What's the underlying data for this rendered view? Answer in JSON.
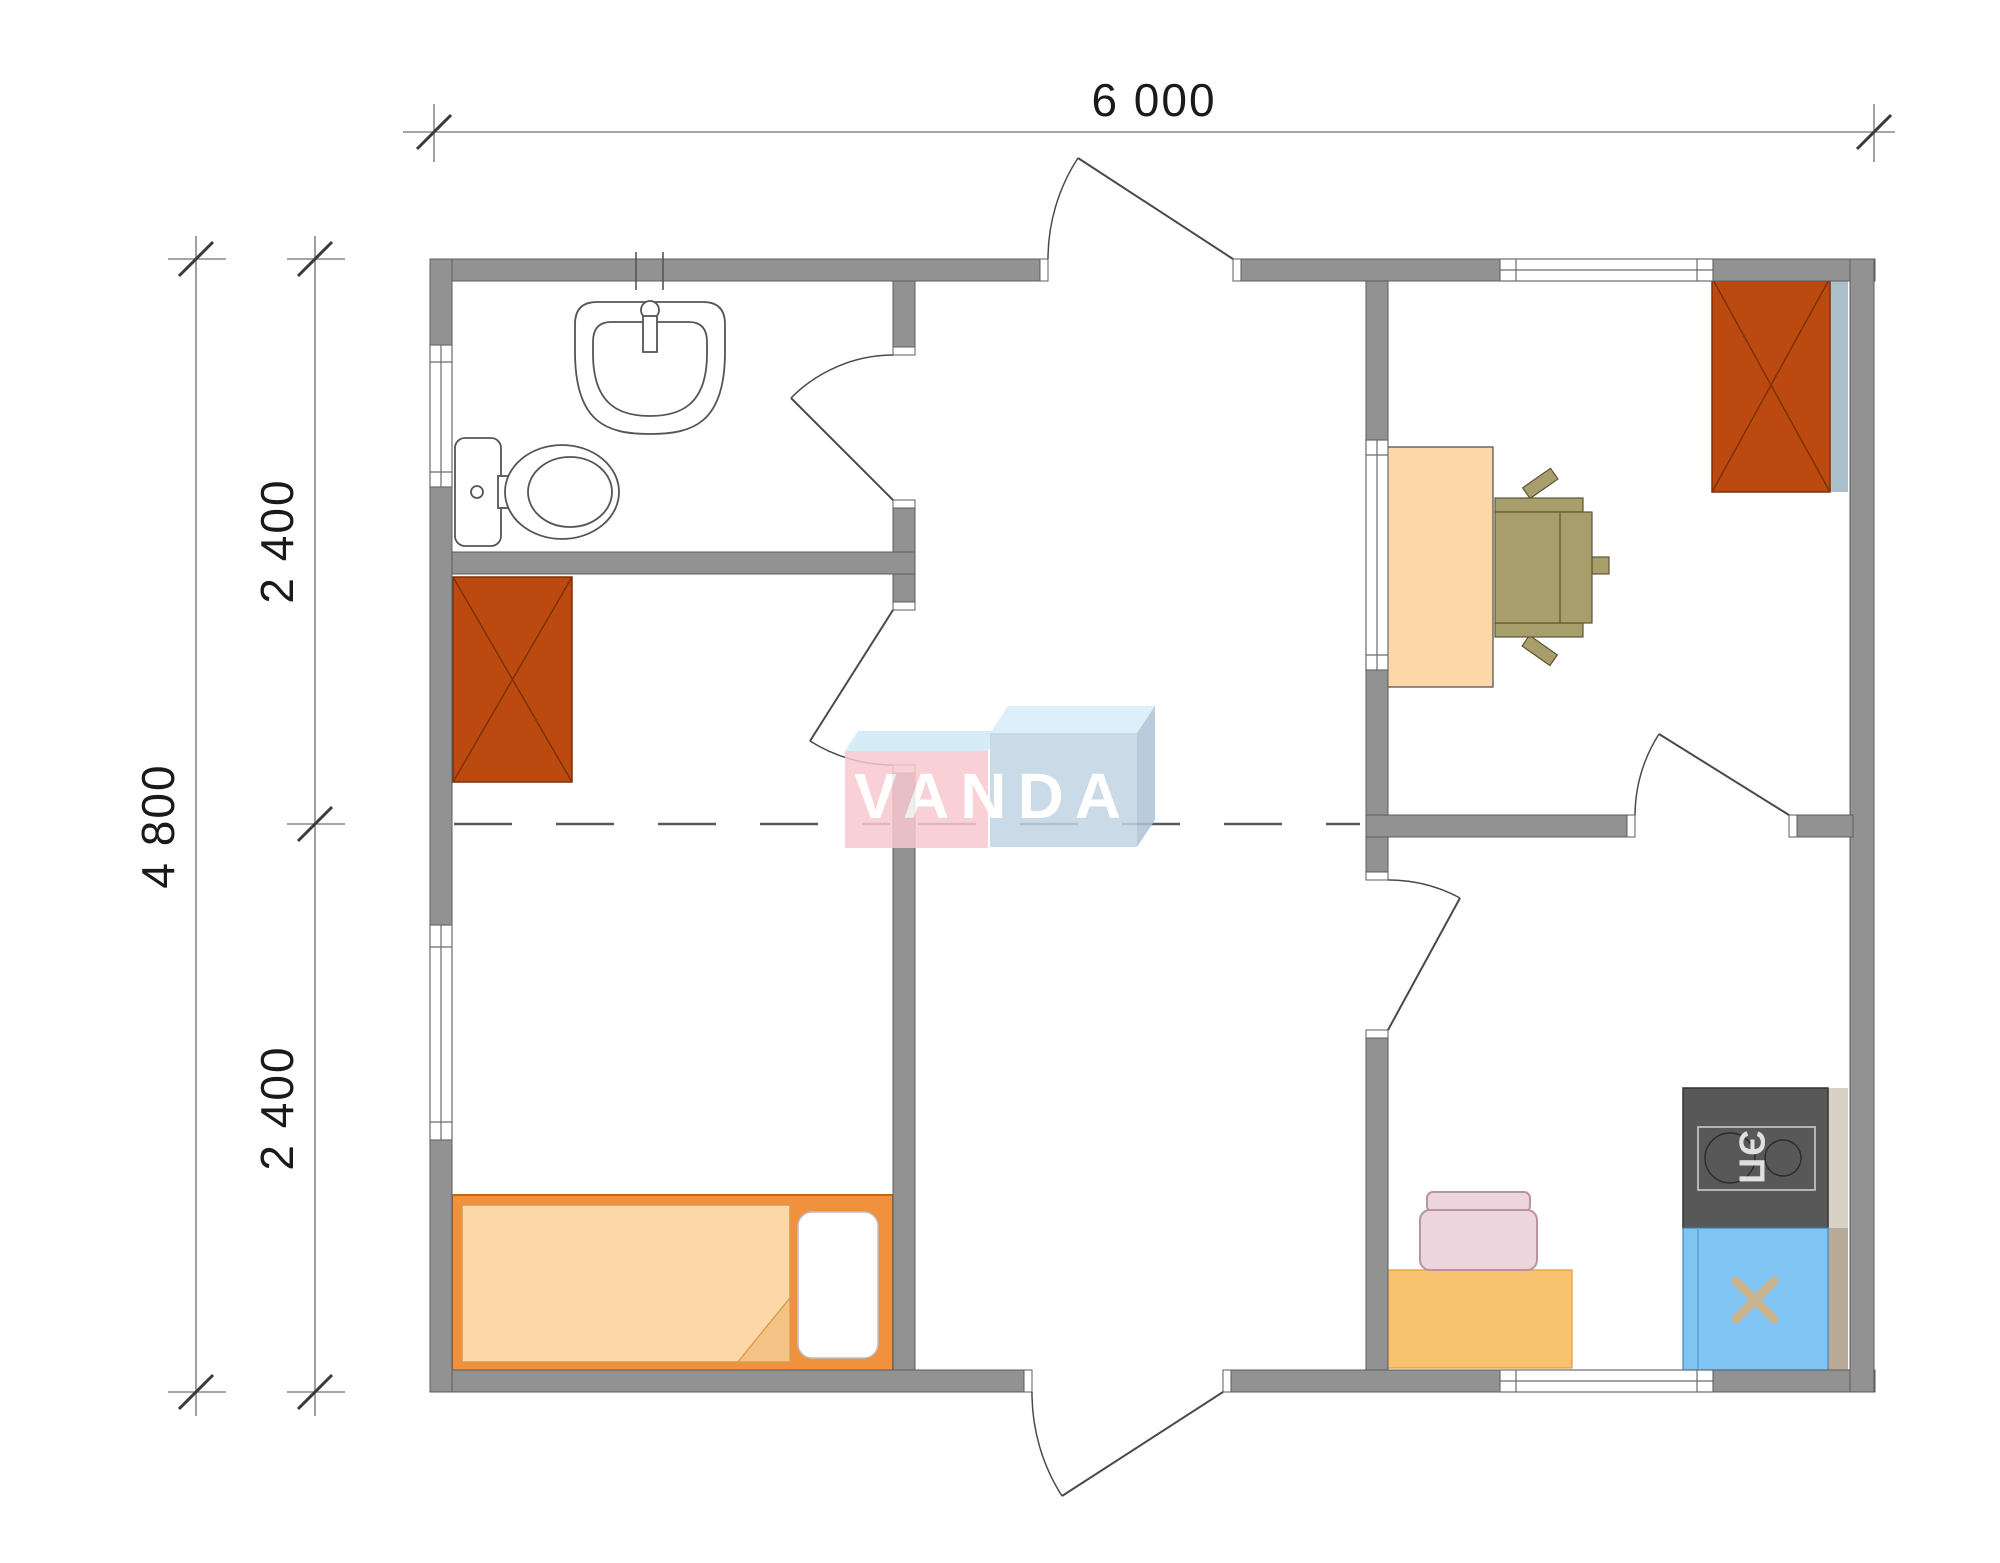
{
  "drawing": {
    "type": "floor-plan"
  },
  "dimensions": {
    "top_width": "6 000",
    "left_total_height": "4 800",
    "left_upper_height": "2 400",
    "left_lower_height": "2 400"
  },
  "watermark": {
    "text": "VANDA"
  },
  "kitchen": {
    "stove_label": "ЭП"
  },
  "colors": {
    "wall": "#929292",
    "wallStroke": "#5c5c5c",
    "windowStroke": "#6a6a6a",
    "door": "#4a4a4a",
    "dash": "#5a5a5a",
    "dimLine": "#888888",
    "dimSlash": "#3a3a3a",
    "dimText": "#1a1a1a",
    "wardrobe": "#bc4a10",
    "wardrobeStroke": "#7e3008",
    "desk": "#fcd8a8",
    "deskStroke": "#4a4a4a",
    "chair": "#a89e6c",
    "chairStroke": "#5e5434",
    "bedFrame": "#f0913e",
    "bedFrameStroke": "#c2661a",
    "mattress": "#fcd8a8",
    "mattressStroke": "#d89b4e",
    "fold": "#f5c285",
    "pillowStroke": "#bfbfbf",
    "table": "#f9c271",
    "tableStroke": "#dd9e42",
    "pinkChair": "#ecd5dc",
    "pinkChairStroke": "#bc93a0",
    "stove": "#585858",
    "stoveStroke": "#333333",
    "stovePanel": "#bfbfbf",
    "stoveText": "#e0e0e0",
    "sink": "#7fc4f3",
    "sinkStroke": "#3f87c0",
    "sinkDoorLine": "#5fa9dc",
    "sinkCross": "#c9b28e",
    "shadowBlue": "#abbfcb",
    "shadowTan": "#b7ab97",
    "logoPink": "#f7c8d0",
    "logoCyan": "#cfeaf6",
    "logoBlueFront": "#c3d4e3",
    "logoBlueTop": "#d5eef8",
    "logoBlueSide": "#aec3d6",
    "logoText": "#ffffff"
  }
}
